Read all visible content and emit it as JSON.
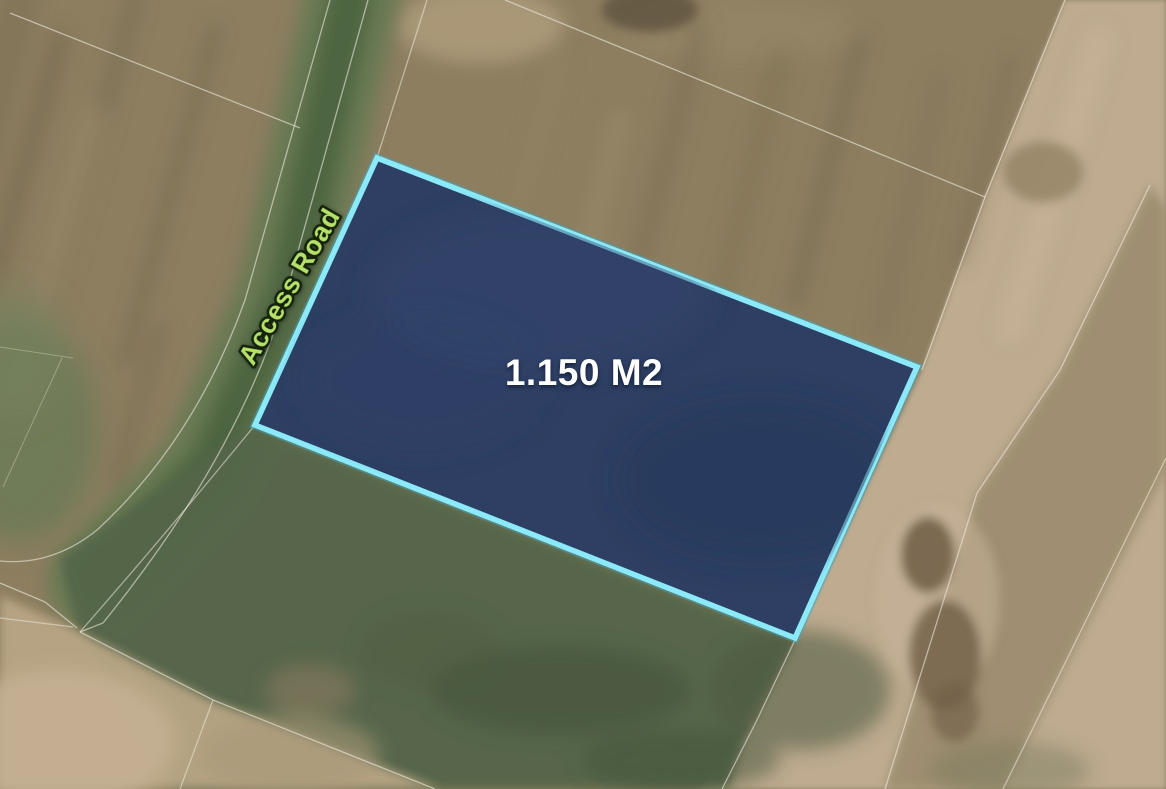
{
  "map": {
    "description": "Satellite aerial view with highlighted land parcel for sale",
    "parcel": {
      "area_label": "1.150 M2",
      "area_label_color": "#ffffff",
      "points_px": "377,158 917,367 795,638 255,425",
      "fill_color": "#2b3d63",
      "border_color": "#8ce9f8",
      "border_glow_color": "#3fa8c2"
    },
    "road": {
      "label": "Access Road",
      "label_color": "#b5e06a",
      "label_outline_color": "#16230b"
    },
    "palette": {
      "field_brown": "#8d7e60",
      "field_tan": "#c0ad92",
      "field_green": "#55664a",
      "boundary_line": "#ece9dc"
    }
  }
}
